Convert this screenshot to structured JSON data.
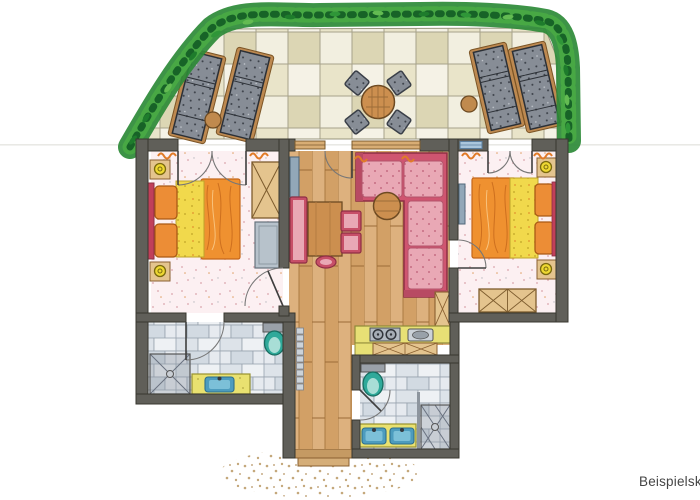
{
  "watermark": "Beispielski",
  "palette": {
    "wall": "#605f59",
    "hedge_dark": "#1e7c2c",
    "hedge_mid": "#2c8a37",
    "hedge_light": "#63bb52",
    "paver_khaki": "#e9e4c9",
    "paver_white": "#f5f2e6",
    "wood_floor": "#ddb17e",
    "bedroom_floor": "#fcf0f2",
    "bed_sheet_yellow": "#f1d94c",
    "bed_blanket_orange": "#ef9130",
    "accent_crimson": "#c13f5a",
    "sofa_pink": "#e9a8b5",
    "furniture_wood": "#cc8f4f",
    "wardrobe_tan": "#e4c48e",
    "bath_tile": "#dde3e9",
    "toilet_teal": "#2fa99a",
    "vanity_yellow": "#e9e170",
    "sink_blue": "#4d9cbe",
    "lounger_gray": "#878d96",
    "mat_dot": "#c4a87b"
  },
  "plan": {
    "outdoor": {
      "name": "terrace",
      "features": [
        "hedge-border",
        "stone-paving",
        "sun-lounger",
        "sun-lounger",
        "sun-lounger",
        "sun-lounger",
        "side-table",
        "side-table",
        "round-dining-table",
        "terrace-chair",
        "terrace-chair",
        "terrace-chair",
        "terrace-chair"
      ]
    },
    "rooms": [
      {
        "name": "bedroom-left",
        "furniture": [
          "double-bed",
          "nightstand",
          "nightstand",
          "table-lamp",
          "table-lamp",
          "wardrobe",
          "dresser",
          "terrace-french-door",
          "room-door",
          "curtains"
        ]
      },
      {
        "name": "living-room",
        "furniture": [
          "corner-sofa",
          "coffee-table",
          "dining-table",
          "bench",
          "chair",
          "chair",
          "stool",
          "tv-sideboard",
          "terrace-door",
          "window",
          "window"
        ]
      },
      {
        "name": "bedroom-right",
        "furniture": [
          "double-bed",
          "nightstand",
          "nightstand",
          "table-lamp",
          "table-lamp",
          "wardrobe",
          "wall-tv",
          "terrace-french-door",
          "room-door",
          "window",
          "curtains"
        ]
      },
      {
        "name": "kitchenette",
        "furniture": [
          "counter",
          "stove-two-burners",
          "sink",
          "base-cabinets",
          "tall-cabinet"
        ]
      },
      {
        "name": "bathroom-left",
        "furniture": [
          "shower",
          "vanity-sink",
          "toilet",
          "door"
        ]
      },
      {
        "name": "bathroom-right",
        "furniture": [
          "toilet",
          "double-vanity",
          "shower",
          "door"
        ]
      },
      {
        "name": "hallway",
        "furniture": [
          "radiator",
          "entry-steps",
          "doormat"
        ]
      }
    ]
  }
}
